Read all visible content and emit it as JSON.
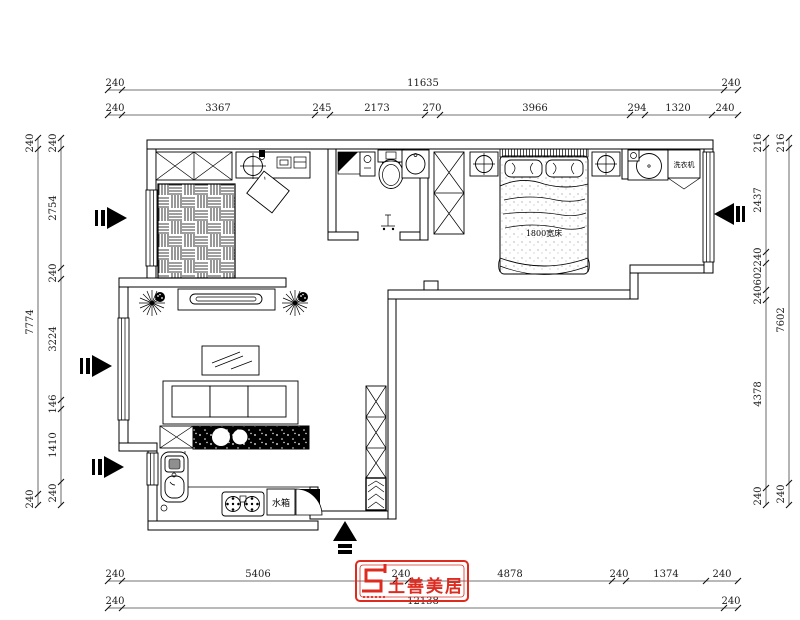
{
  "dimensions": {
    "top_row1": [
      "240",
      "11635",
      "240"
    ],
    "top_row2": [
      "240",
      "3367",
      "245",
      "2173",
      "270",
      "3966",
      "294",
      "1320",
      "240"
    ],
    "bottom_row1": [
      "240",
      "5406",
      "240",
      "4878",
      "240",
      "1374",
      "240"
    ],
    "bottom_row2": [
      "240",
      "12138",
      "240"
    ],
    "left_outer": [
      "240",
      "7774",
      "240"
    ],
    "left_inner": [
      "240",
      "2754",
      "240",
      "3224",
      "146",
      "1410",
      "240"
    ],
    "right_inner": [
      "216",
      "2437",
      "240",
      "602",
      "240",
      "4378",
      "240"
    ],
    "right_outer": [
      "216",
      "7602",
      "240"
    ]
  },
  "labels": {
    "bed": "1800宽床",
    "washing_machine": "洗衣机",
    "water_tank": "水箱"
  },
  "logo": {
    "name": "土善美居"
  },
  "colors": {
    "line": "#000000",
    "logo_red": "#dd2b20",
    "wall_fill": "#ffffff"
  }
}
